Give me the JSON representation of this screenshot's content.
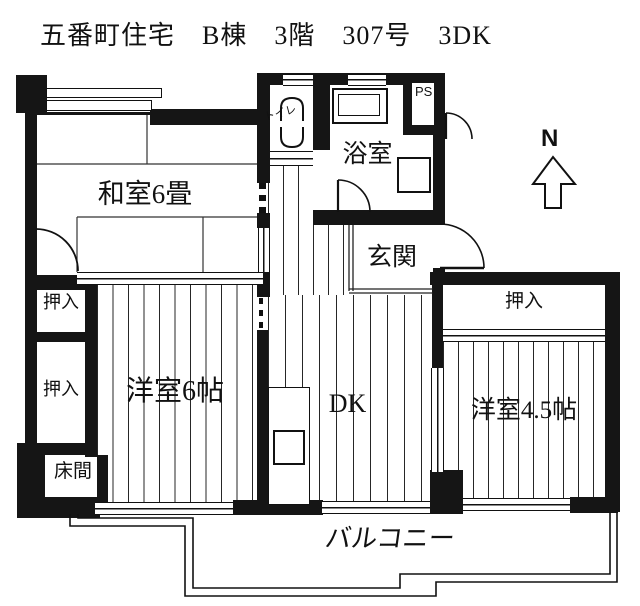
{
  "title": "五番町住宅　B棟　3階　307号　3DK",
  "compass": {
    "label": "N"
  },
  "rooms": {
    "washitsu": "和室6畳",
    "oshiire_top": "押入",
    "oshiire_mid": "押入",
    "tokonoma": "床間",
    "yoshitsu6": "洋室6帖",
    "dk": "DK",
    "genkan": "玄関",
    "yokushitsu": "浴室",
    "toilet": "トイレ",
    "ps": "PS",
    "oshiire_right": "押入",
    "yoshitsu45": "洋室4.5帖",
    "balcony": "バルコニー"
  },
  "colors": {
    "wall": "#151515",
    "background": "#ffffff",
    "floor_line": "#262626"
  }
}
